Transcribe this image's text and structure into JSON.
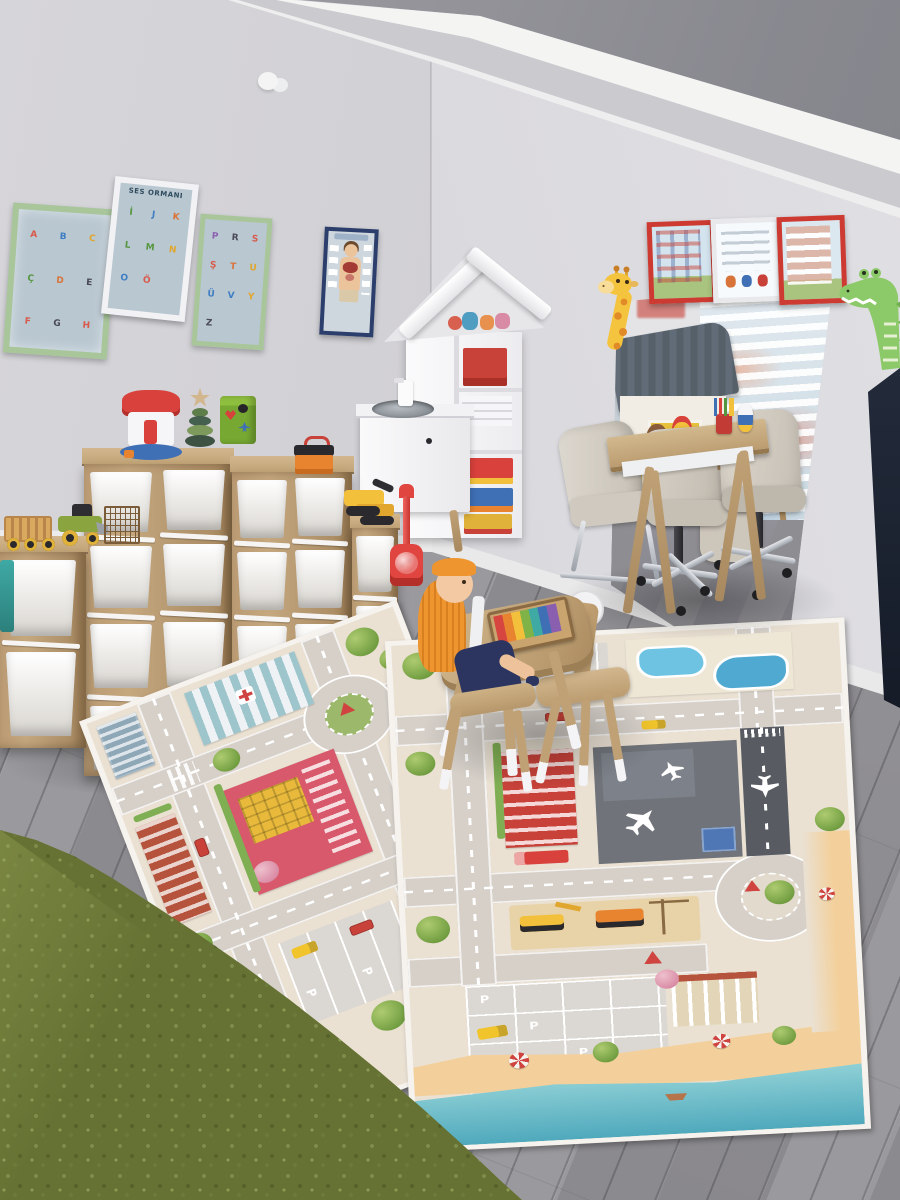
{
  "scene": {
    "setting": "children's playroom with toy storage shelves, play rugs, kids table and wall posters"
  },
  "palette": {
    "wall": "#d8d7db",
    "ceiling_recess": "#8e8e95",
    "white_trim": "#f4f4f3",
    "floor_wood": "#919094",
    "shelf_wood": "#b6976f",
    "bin_white": "#f4f3f1",
    "rug_base": "#eae1d3",
    "rug_road": "#d6d0c9",
    "beach_sand": "#f3d09b",
    "sea": "#6fc0cc",
    "shag_rug_green": "#667233",
    "poster_frame_green": "#a9c69b",
    "poster_frame_red": "#cc3a31",
    "poster_frame_blue": "#2c3e6b",
    "taxi_yellow": "#f0c42a",
    "vacuum_red": "#e04540"
  },
  "left_wall_posters": {
    "poster_a": {
      "letters": [
        "A",
        "B",
        "C",
        "Ç",
        "D",
        "E",
        "F",
        "G",
        "H"
      ]
    },
    "poster_b": {
      "title": "SES ORMANI",
      "letters": [
        "İ",
        "J",
        "K",
        "L",
        "M",
        "N",
        "O",
        "Ö"
      ]
    },
    "poster_c": {
      "letters": [
        "P",
        "R",
        "S",
        "Ş",
        "T",
        "U",
        "Ü",
        "V",
        "Y",
        "Z"
      ]
    }
  },
  "rug": {
    "parking_label": "P"
  }
}
